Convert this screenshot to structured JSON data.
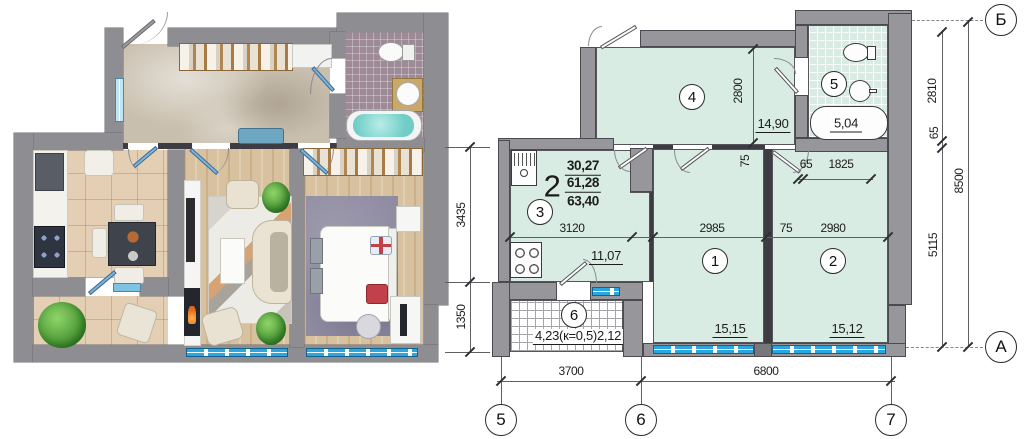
{
  "colors": {
    "plan_fill": "#d9ece3",
    "wall_gray": "#96969b",
    "window_blue": "#2aa7e0",
    "bath_mosaic": "#9d8a96",
    "wood_floor": "#d8c19e"
  },
  "technical_plan": {
    "summary": {
      "rooms_count": "2",
      "living_area": "30,27",
      "usable_area": "61,28",
      "total_area": "63,40"
    },
    "rooms": {
      "r1": {
        "num": "1",
        "area": "15,15"
      },
      "r2": {
        "num": "2",
        "area": "15,12"
      },
      "r3": {
        "num": "3",
        "area": "11,07"
      },
      "r4": {
        "num": "4",
        "area": "14,90"
      },
      "r5": {
        "num": "5",
        "area": "5,04"
      },
      "r6": {
        "num": "6",
        "area": "4,23(к=0,5)2,12"
      }
    },
    "dims": {
      "kitchen_width": "3120",
      "room1_width": "2985",
      "partition": "75",
      "room2_width": "2980",
      "hall_depth": "2800",
      "hall_wall": "75",
      "niche_65": "65",
      "niche_1825": "1825",
      "bottom_left": "3700",
      "bottom_right": "6800",
      "left_upper": "3435",
      "left_lower": "1350",
      "right_upper": "2810",
      "right_mid": "65",
      "right_lower": "5115",
      "right_total": "8500"
    },
    "axes": {
      "col5": "5",
      "col6": "6",
      "col7": "7",
      "rowB": "Б",
      "rowA": "А"
    }
  }
}
